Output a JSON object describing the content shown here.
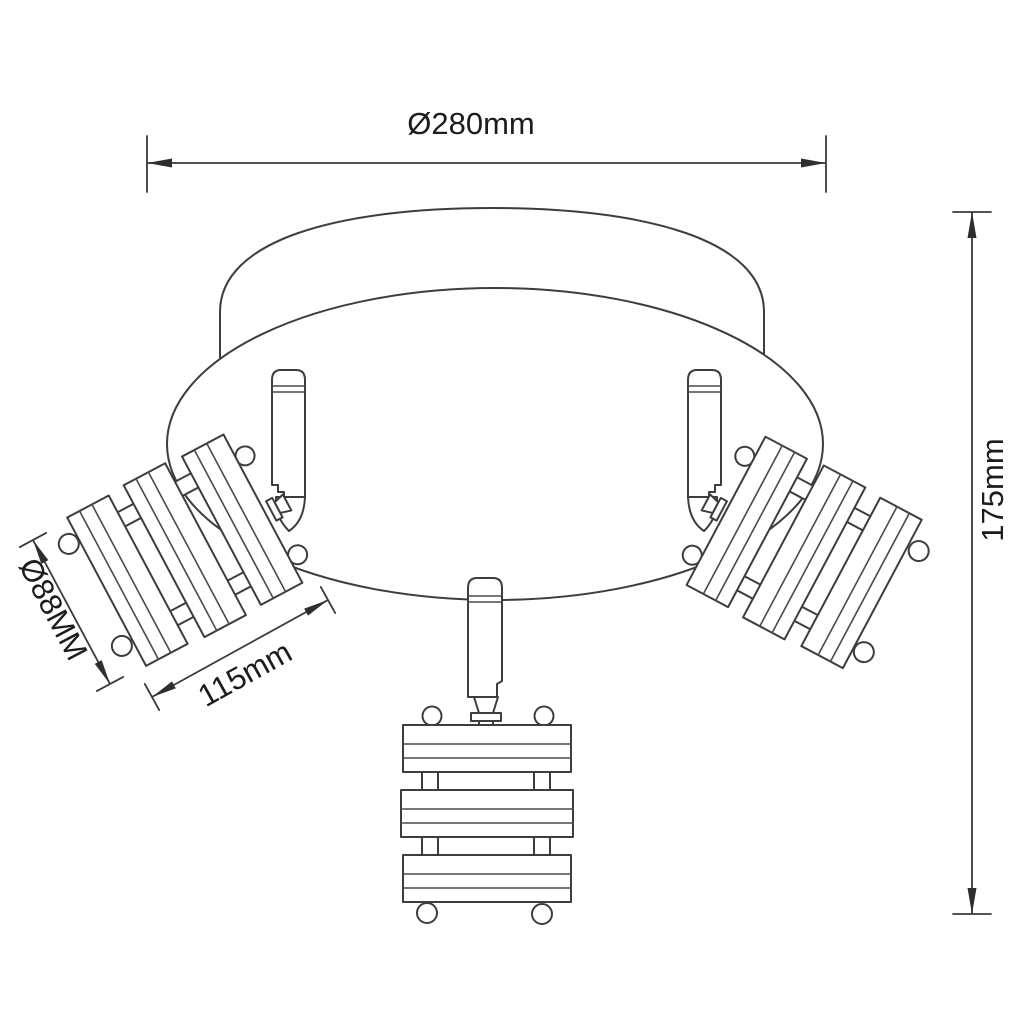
{
  "figure": {
    "type": "technical-drawing",
    "subject": "Three-head ceiling spotlight fixture with wooden slat shades, dimensioned outline drawing",
    "background_color": "#ffffff",
    "line_color": "#3d3d3d",
    "text_color": "#1c1c1c",
    "labels": {
      "canopy_diameter": "Ø280mm",
      "overall_height": "175mm",
      "head_diameter": "Ø88MM",
      "head_length": "115mm"
    },
    "parts": [
      "canopy-top-plate",
      "canopy-base-ellipse",
      "spot-arm-left",
      "spot-arm-right",
      "spot-arm-bottom",
      "spot-head-left",
      "spot-head-right",
      "spot-head-bottom"
    ]
  }
}
